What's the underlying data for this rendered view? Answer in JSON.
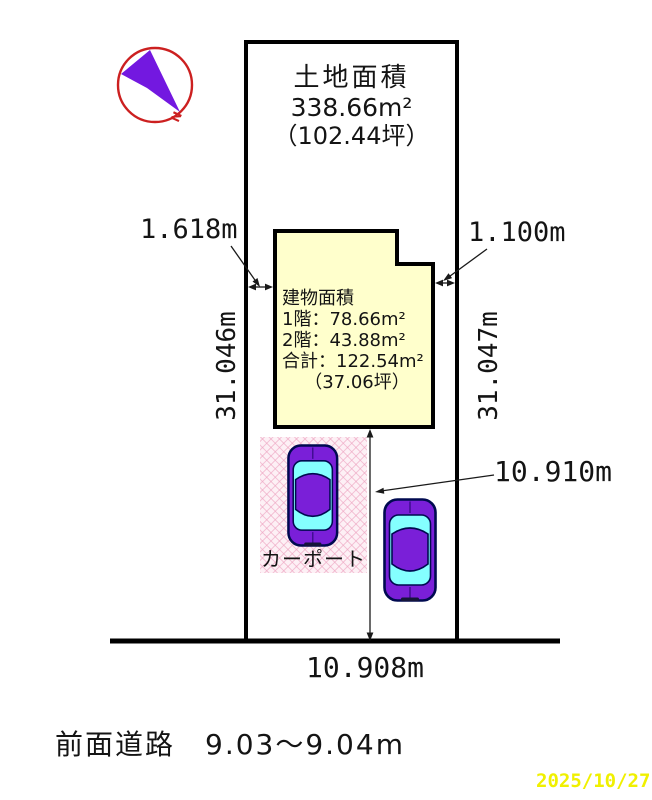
{
  "compass": {
    "north_label": "N"
  },
  "land_area": {
    "title": "土地面積",
    "area": "338.66m²",
    "tsubo": "（102.44坪）"
  },
  "building_area": {
    "title": "建物面積",
    "floor1": "1階：78.66m²",
    "floor2": "2階：43.88m²",
    "total": "合計：122.54m²",
    "tsubo": "（37.06坪）"
  },
  "dimensions": {
    "gap_left": "1.618m",
    "gap_right": "1.100m",
    "depth_left": "31.046m",
    "depth_right": "31.047m",
    "yard_depth": "10.910m",
    "frontage": "10.908m"
  },
  "carport": {
    "label": "カーポート"
  },
  "front_road": {
    "label": "前面道路　9.03～9.04m"
  },
  "footer": {
    "date": "2025/10/27"
  },
  "colors": {
    "building_fill": "#ffffcc",
    "carport_fill": "#fdf0f5",
    "car_body": "#7a1fd8",
    "car_window": "#84ffff",
    "compass_ring": "#cc2020",
    "needle": "#7318e0",
    "date_text": "#f0f000",
    "outline": "#000000"
  }
}
